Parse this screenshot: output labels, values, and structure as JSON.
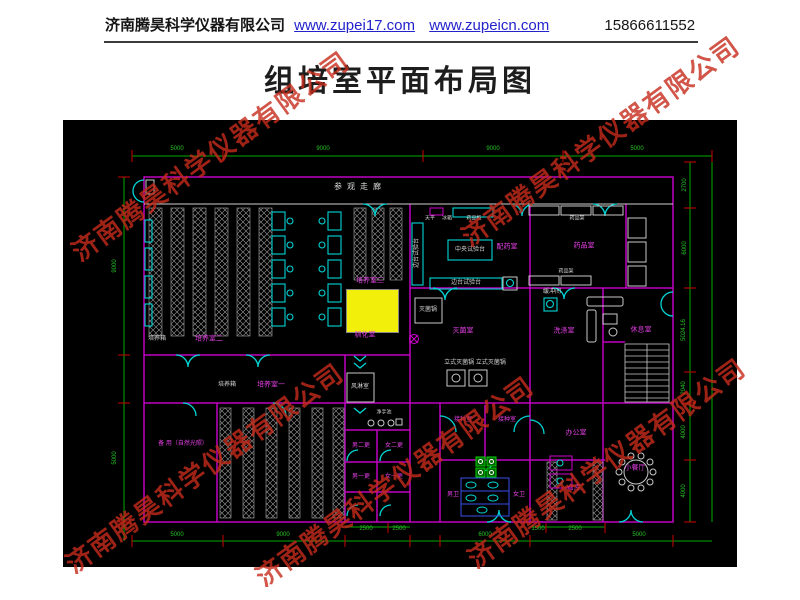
{
  "header": {
    "company": "济南腾昊科学仪器有限公司",
    "link1": "www.zupei17.com",
    "link2": "www.zupeicn.com",
    "phone": "15866611552"
  },
  "title": "组培室平面布局图",
  "watermark": {
    "text": "济南腾昊科学仪器有限公司",
    "color": "rgba(198,44,27,0.8)",
    "positions": [
      {
        "x": 210,
        "y": 155
      },
      {
        "x": 600,
        "y": 140
      },
      {
        "x": 204,
        "y": 467
      },
      {
        "x": 394,
        "y": 480
      },
      {
        "x": 606,
        "y": 462
      }
    ]
  },
  "cad": {
    "colors": {
      "background": "#000000",
      "wall": "#c000c0",
      "door": "#00d5d5",
      "dimension_line": "#00aa00",
      "dimension_tick": "#cc0000",
      "room_label": "#e23ee2",
      "equipment_label": "#d5d5d5",
      "highlight": "#f2ef0a"
    },
    "labels": [
      {
        "t": "参观走廊",
        "x": 297,
        "y": 67,
        "c": "corr"
      },
      {
        "t": "培养室二",
        "x": 146,
        "y": 219,
        "c": "room"
      },
      {
        "t": "培养室三",
        "x": 307,
        "y": 161,
        "c": "room"
      },
      {
        "t": "驯化室",
        "x": 302,
        "y": 215,
        "c": "room"
      },
      {
        "t": "配药室",
        "x": 444,
        "y": 127,
        "c": "room"
      },
      {
        "t": "药品室",
        "x": 521,
        "y": 126,
        "c": "room"
      },
      {
        "t": "灭菌室",
        "x": 400,
        "y": 211,
        "c": "room"
      },
      {
        "t": "洗涤室",
        "x": 501,
        "y": 211,
        "c": "room"
      },
      {
        "t": "休息室",
        "x": 578,
        "y": 210,
        "c": "room"
      },
      {
        "t": "备 用（自然光照）",
        "x": 120,
        "y": 324,
        "c": "room",
        "s": 6
      },
      {
        "t": "培养室一",
        "x": 208,
        "y": 265,
        "c": "room"
      },
      {
        "t": "男二更",
        "x": 298,
        "y": 326,
        "c": "room",
        "s": 6
      },
      {
        "t": "女二更",
        "x": 331,
        "y": 326,
        "c": "room",
        "s": 6
      },
      {
        "t": "男一更",
        "x": 298,
        "y": 357,
        "c": "room",
        "s": 6
      },
      {
        "t": "女一更",
        "x": 331,
        "y": 357,
        "c": "room",
        "s": 6
      },
      {
        "t": "接种室",
        "x": 400,
        "y": 300,
        "c": "room",
        "s": 6
      },
      {
        "t": "接种室",
        "x": 444,
        "y": 300,
        "c": "room",
        "s": 6
      },
      {
        "t": "男卫",
        "x": 390,
        "y": 375,
        "c": "room",
        "s": 6
      },
      {
        "t": "女卫",
        "x": 456,
        "y": 375,
        "c": "room",
        "s": 6
      },
      {
        "t": "办公室",
        "x": 513,
        "y": 313,
        "c": "room"
      },
      {
        "t": "仓库",
        "x": 511,
        "y": 368,
        "c": "room"
      },
      {
        "t": "小餐厅",
        "x": 572,
        "y": 348,
        "c": "room"
      },
      {
        "t": "培养箱",
        "x": 94,
        "y": 219,
        "c": "equip"
      },
      {
        "t": "培养箱",
        "x": 164,
        "y": 265,
        "c": "equip"
      },
      {
        "t": "缓冲间",
        "x": 489,
        "y": 172,
        "c": "equip"
      },
      {
        "t": "风淋室",
        "x": 297,
        "y": 267,
        "c": "equip"
      },
      {
        "t": "净手池",
        "x": 321,
        "y": 293,
        "c": "equip",
        "s": 5
      },
      {
        "t": "中央试验台",
        "x": 407,
        "y": 130,
        "c": "equip"
      },
      {
        "t": "边台试验台",
        "x": 354,
        "y": 133,
        "c": "equip",
        "r": 1
      },
      {
        "t": "边台试验台",
        "x": 403,
        "y": 163,
        "c": "equip"
      },
      {
        "t": "药品柜",
        "x": 411,
        "y": 99,
        "c": "equip",
        "s": 5
      },
      {
        "t": "天平",
        "x": 367,
        "y": 99,
        "c": "equip",
        "s": 5
      },
      {
        "t": "冰箱",
        "x": 384,
        "y": 99,
        "c": "equip",
        "s": 5
      },
      {
        "t": "药品架",
        "x": 514,
        "y": 99,
        "c": "equip",
        "s": 5
      },
      {
        "t": "药品架",
        "x": 503,
        "y": 152,
        "c": "equip",
        "s": 5
      },
      {
        "t": "灭菌锅",
        "x": 365,
        "y": 190,
        "c": "equip"
      },
      {
        "t": "立式灭菌锅 立式灭菌锅",
        "x": 412,
        "y": 243,
        "c": "equip"
      },
      {
        "t": "5000",
        "x": 114,
        "y": 29,
        "c": "dim"
      },
      {
        "t": "9000",
        "x": 260,
        "y": 29,
        "c": "dim"
      },
      {
        "t": "9000",
        "x": 430,
        "y": 29,
        "c": "dim"
      },
      {
        "t": "5000",
        "x": 574,
        "y": 29,
        "c": "dim"
      },
      {
        "t": "5000",
        "x": 114,
        "y": 415,
        "c": "dim"
      },
      {
        "t": "9000",
        "x": 220,
        "y": 415,
        "c": "dim"
      },
      {
        "t": "2500",
        "x": 303,
        "y": 409,
        "c": "dim"
      },
      {
        "t": "2500",
        "x": 336,
        "y": 409,
        "c": "dim"
      },
      {
        "t": "6000",
        "x": 422,
        "y": 415,
        "c": "dim"
      },
      {
        "t": "1500",
        "x": 475,
        "y": 409,
        "c": "dim"
      },
      {
        "t": "2500",
        "x": 512,
        "y": 409,
        "c": "dim"
      },
      {
        "t": "5000",
        "x": 576,
        "y": 415,
        "c": "dim"
      },
      {
        "t": "2700",
        "x": 622,
        "y": 65,
        "c": "dim",
        "r": 1
      },
      {
        "t": "6000",
        "x": 622,
        "y": 128,
        "c": "dim",
        "r": 1
      },
      {
        "t": "5024.16",
        "x": 621,
        "y": 210,
        "c": "dim",
        "r": 1
      },
      {
        "t": "2040",
        "x": 621,
        "y": 268,
        "c": "dim",
        "r": 1
      },
      {
        "t": "4000",
        "x": 621,
        "y": 312,
        "c": "dim",
        "r": 1
      },
      {
        "t": "4000",
        "x": 621,
        "y": 371,
        "c": "dim",
        "r": 1
      },
      {
        "t": "9000",
        "x": 52,
        "y": 146,
        "c": "dim",
        "r": 1
      },
      {
        "t": "5000",
        "x": 52,
        "y": 338,
        "c": "dim",
        "r": 1
      }
    ]
  }
}
